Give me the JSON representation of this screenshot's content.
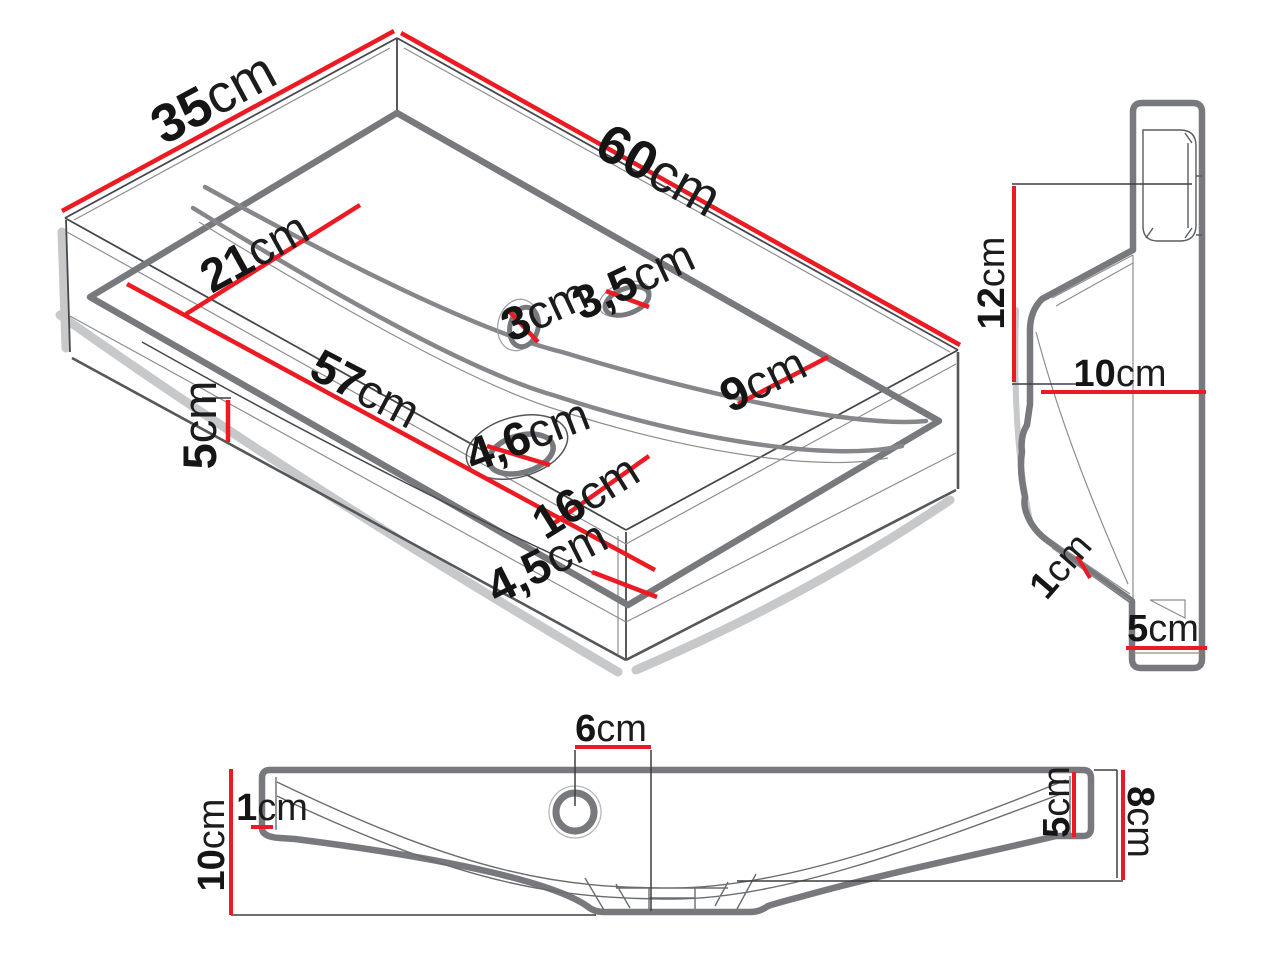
{
  "colors": {
    "background": "#ffffff",
    "dimension_red": "#ec1b23",
    "outline_gray": "#77797c",
    "line_dark": "#46484b",
    "text_black": "#151515"
  },
  "views": {
    "isometric": {
      "dims": {
        "depth": {
          "v": "35",
          "u": "cm"
        },
        "width": {
          "v": "60",
          "u": "cm"
        },
        "left_deck": {
          "v": "21",
          "u": "cm"
        },
        "overflow_hole": {
          "v": "3",
          "u": "cm"
        },
        "faucet_hole": {
          "v": "3,5",
          "u": "cm"
        },
        "back_deck": {
          "v": "9",
          "u": "cm"
        },
        "basin_width": {
          "v": "57",
          "u": "cm"
        },
        "left_height": {
          "v": "5",
          "u": "cm"
        },
        "drain_hole": {
          "v": "4,6",
          "u": "cm"
        },
        "basin_depth": {
          "v": "16",
          "u": "cm"
        },
        "front_rim": {
          "v": "4,5",
          "u": "cm"
        }
      }
    },
    "side": {
      "dims": {
        "back_height": {
          "v": "12",
          "u": "cm"
        },
        "depth": {
          "v": "10",
          "u": "cm"
        },
        "rim_thickness": {
          "v": "1",
          "u": "cm"
        },
        "foot_depth": {
          "v": "5",
          "u": "cm"
        }
      }
    },
    "front": {
      "dims": {
        "faucet_offset": {
          "v": "6",
          "u": "cm"
        },
        "rim_thickness": {
          "v": "1",
          "u": "cm"
        },
        "height": {
          "v": "10",
          "u": "cm"
        },
        "right_rim_height": {
          "v": "5",
          "u": "cm"
        },
        "back_height": {
          "v": "8",
          "u": "cm"
        }
      }
    }
  }
}
